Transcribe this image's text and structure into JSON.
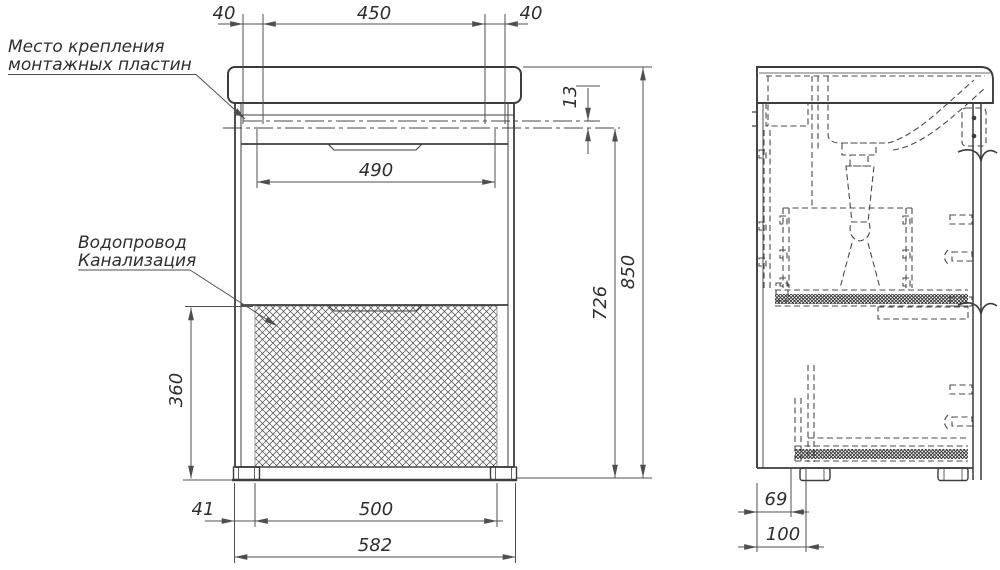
{
  "drawing": {
    "background": "#ffffff",
    "line_color": "#3c3c3c",
    "dim_line_color": "#4f4f4f",
    "text_color": "#2e2e2e",
    "annotations": {
      "mounting_plates": {
        "line1": "Место крепления",
        "line2": "монтажных пластин"
      },
      "plumbing": {
        "line1": "Водопровод",
        "line2": "Канализация"
      }
    },
    "front_view": {
      "dims": {
        "offset_left": "40",
        "mounting_span": "450",
        "offset_right": "40",
        "rim_to_plate": "13",
        "inner_width": "490",
        "service_zone_height": "360",
        "foot_offset": "41",
        "feet_span": "500",
        "overall_width": "582",
        "plate_line_to_floor": "726",
        "overall_height": "850"
      }
    },
    "side_view": {
      "dims": {
        "front_offset": "69",
        "front_depth": "100"
      }
    }
  }
}
